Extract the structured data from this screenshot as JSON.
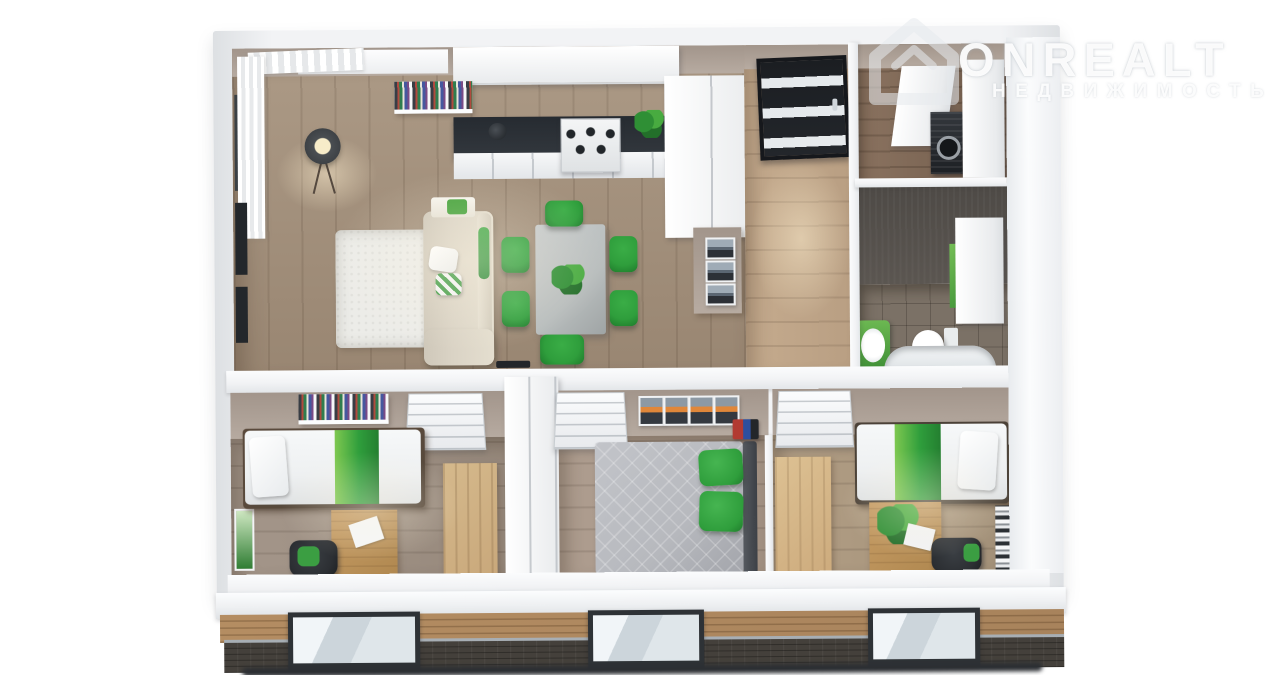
{
  "watermark": {
    "brand": "ONREALT",
    "subtitle": "НЕДВИЖИМОСТЬ",
    "icon": "house-icon"
  },
  "colors": {
    "accent_green": "#2f9e3c",
    "accent_green_light": "#7ec850",
    "living_floor": "#998672",
    "living_floor_light": "#ac9a86",
    "corridor_floor": "#b89e82",
    "bedroom1_floor": "#96887b",
    "bedroom2_floor": "#a08f81",
    "bedroom3_floor": "#a29078",
    "wall_white": "#f2f3f5",
    "wall_shade": "#dde0e3",
    "wall_face": "#b7aba1",
    "bath_wall": "#5b5651",
    "bath_floor": "#7b7166",
    "counter_dark": "#33383e",
    "entry_door": "#23262b",
    "facade_wood": "#a8835c",
    "facade_brick": "#44403b",
    "window_glass": "#dfe6ea",
    "window_frame": "#2e3236",
    "sofa_beige": "#dad3c5",
    "rug_white": "#ecece8",
    "table_gray": "#b8bdbd",
    "quilt_gray": "#b7b9be",
    "bed_white": "#eef0f1",
    "wardrobe_wood": "#c9a87b",
    "chair_dark": "#2c2f33",
    "ground_shadow": "#2c2f33"
  }
}
